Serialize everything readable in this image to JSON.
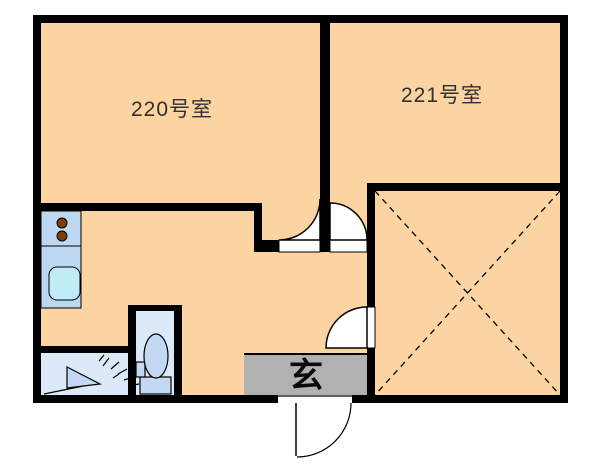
{
  "floorplan": {
    "rooms": [
      {
        "id": "room-220",
        "label": "220号室"
      },
      {
        "id": "room-221",
        "label": "221号室"
      }
    ],
    "entrance": {
      "label": "玄"
    },
    "features": {
      "kitchen": "stove-and-sink-counter",
      "bathroom": "shower-room",
      "toilet": "toilet-room",
      "storage": "x-marked-area",
      "doors": [
        "room-220-door",
        "room-221-door",
        "hall-storage-door",
        "entrance-door"
      ]
    },
    "colors": {
      "outside": "#FFFFFF",
      "wall": "#000000",
      "floor": "#FBD4A2",
      "counter": "#BDD7F0",
      "sink": "#BFECF7",
      "burner": "#7D3E10",
      "wet_room": "#DCE9F8",
      "fixture": "#C3D8F2",
      "mat": "#B1B1B1",
      "door": "#FFFFFF",
      "label": "#303030"
    }
  }
}
